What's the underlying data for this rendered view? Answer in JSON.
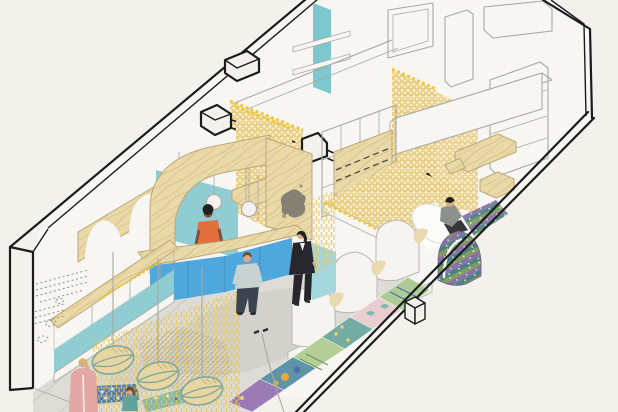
{
  "meta": {
    "kind": "architectural-axonometric-cutaway-illustration",
    "subject": "interior design drawing of a long retail/studio space with arched plywood portal, service counter, vaulted booths and patterned rugs",
    "viewbox": "0 0 618 412",
    "width": 618,
    "height": 412
  },
  "palette": {
    "bg": "#f2f1ec",
    "wall_white": "#f7f6f2",
    "line_black": "#1c1c1c",
    "line_gray": "#a9a8a3",
    "sketch_gray": "#8f8f8b",
    "floor": "#dcdbd6",
    "floor_line": "#c9c8c2",
    "shadow": "#c6c5c0",
    "plywood": "#ead9a8",
    "plywood_edge": "#bca878",
    "plywood_grain": "#d8c188",
    "teal": "#8fcdd3",
    "teal_light": "#7cc8ce",
    "teal_pale": "#a5d8dc",
    "counter_blue": "#4fa8db",
    "counter_blue_dark": "#3e93c4",
    "scale_base": "#f6ecca",
    "scale_dot": "#e3bf62",
    "fringe": "#e5c45c",
    "zigzag": "#efc83c",
    "vault_white": "#f5f4f0",
    "vault_line": "#b8b7b3",
    "glass": "#ffffff",
    "stain": "#6b6b66",
    "basket": "#e7d5a2",
    "basket_line": "#7fa79b",
    "mosaic_blue": "#4f7fb5",
    "mosaic_teal": "#7fb9b0",
    "rug_p1": "#9a7bb5",
    "rug_p2": "#5e93a8",
    "rug_p3": "#b5ce96",
    "rug_p4": "#74aba2",
    "rug_p5": "#e9cecf",
    "rug_p6": "#aecb97",
    "rug_orange": "#e8a83c",
    "rug_blue": "#4c6fa8",
    "rug_green_dark": "#6f9657",
    "rug_yellow": "#ebd26a",
    "rug_teal_leaf": "#79b9ae",
    "rug_green": "#7b9e5a",
    "rug_purple": "#8a6fa8",
    "rug_teal2": "#4f7f86",
    "skin_light": "#d8a98c",
    "skin_dark": "#7a5240",
    "hair_dark": "#23211f",
    "hair_brown": "#6e4a2e",
    "hair_blond": "#d8b66a",
    "orange_top": "#e2703d",
    "tee_gray": "#c7d3d1",
    "jeans": "#3c4450",
    "suit_black": "#26262c",
    "coat_pink": "#e3a8a6",
    "child_teal": "#5fa39b",
    "sweater_gray": "#8d918d",
    "pants_dark": "#35373d"
  },
  "elements": [
    "room-shell-outline",
    "left-end-wall",
    "back-wall-window",
    "teal-shelf-panel",
    "wall-cabinets",
    "plywood-arch-portal",
    "scalloped-arch-band",
    "inner-room-teal-wall",
    "yellow-fishscale-curtain-walls",
    "pendant-lamps",
    "service-counter",
    "display-case",
    "fringe-curtains",
    "hanging-lens-baskets",
    "vaulted-booths",
    "rug-covered-arch",
    "patchwork-runner-rug",
    "mosaic-mats",
    "raised-platform",
    "mezzanine-volume",
    "open-shelving",
    "wall-sketch-art",
    "cut-beam-sections"
  ],
  "figures": [
    {
      "role": "staff-woman-at-counter",
      "top": "#e2703d",
      "hair": "#23211f",
      "skin": "#7a5240"
    },
    {
      "role": "customer-man-back",
      "top": "#c7d3d1",
      "bottom": "#3c4450",
      "hair": "#6e4a2e"
    },
    {
      "role": "customer-woman-suit",
      "outfit": "#26262c",
      "hair": "#23211f"
    },
    {
      "role": "visitor-woman-pink-coat",
      "coat": "#e3a8a6",
      "hair": "#d8b66a"
    },
    {
      "role": "child-teal-shirt",
      "top": "#5fa39b",
      "hair": "#6e4a2e"
    },
    {
      "role": "man-sitting-on-arch",
      "top": "#8d918d",
      "bottom": "#35373d"
    }
  ]
}
